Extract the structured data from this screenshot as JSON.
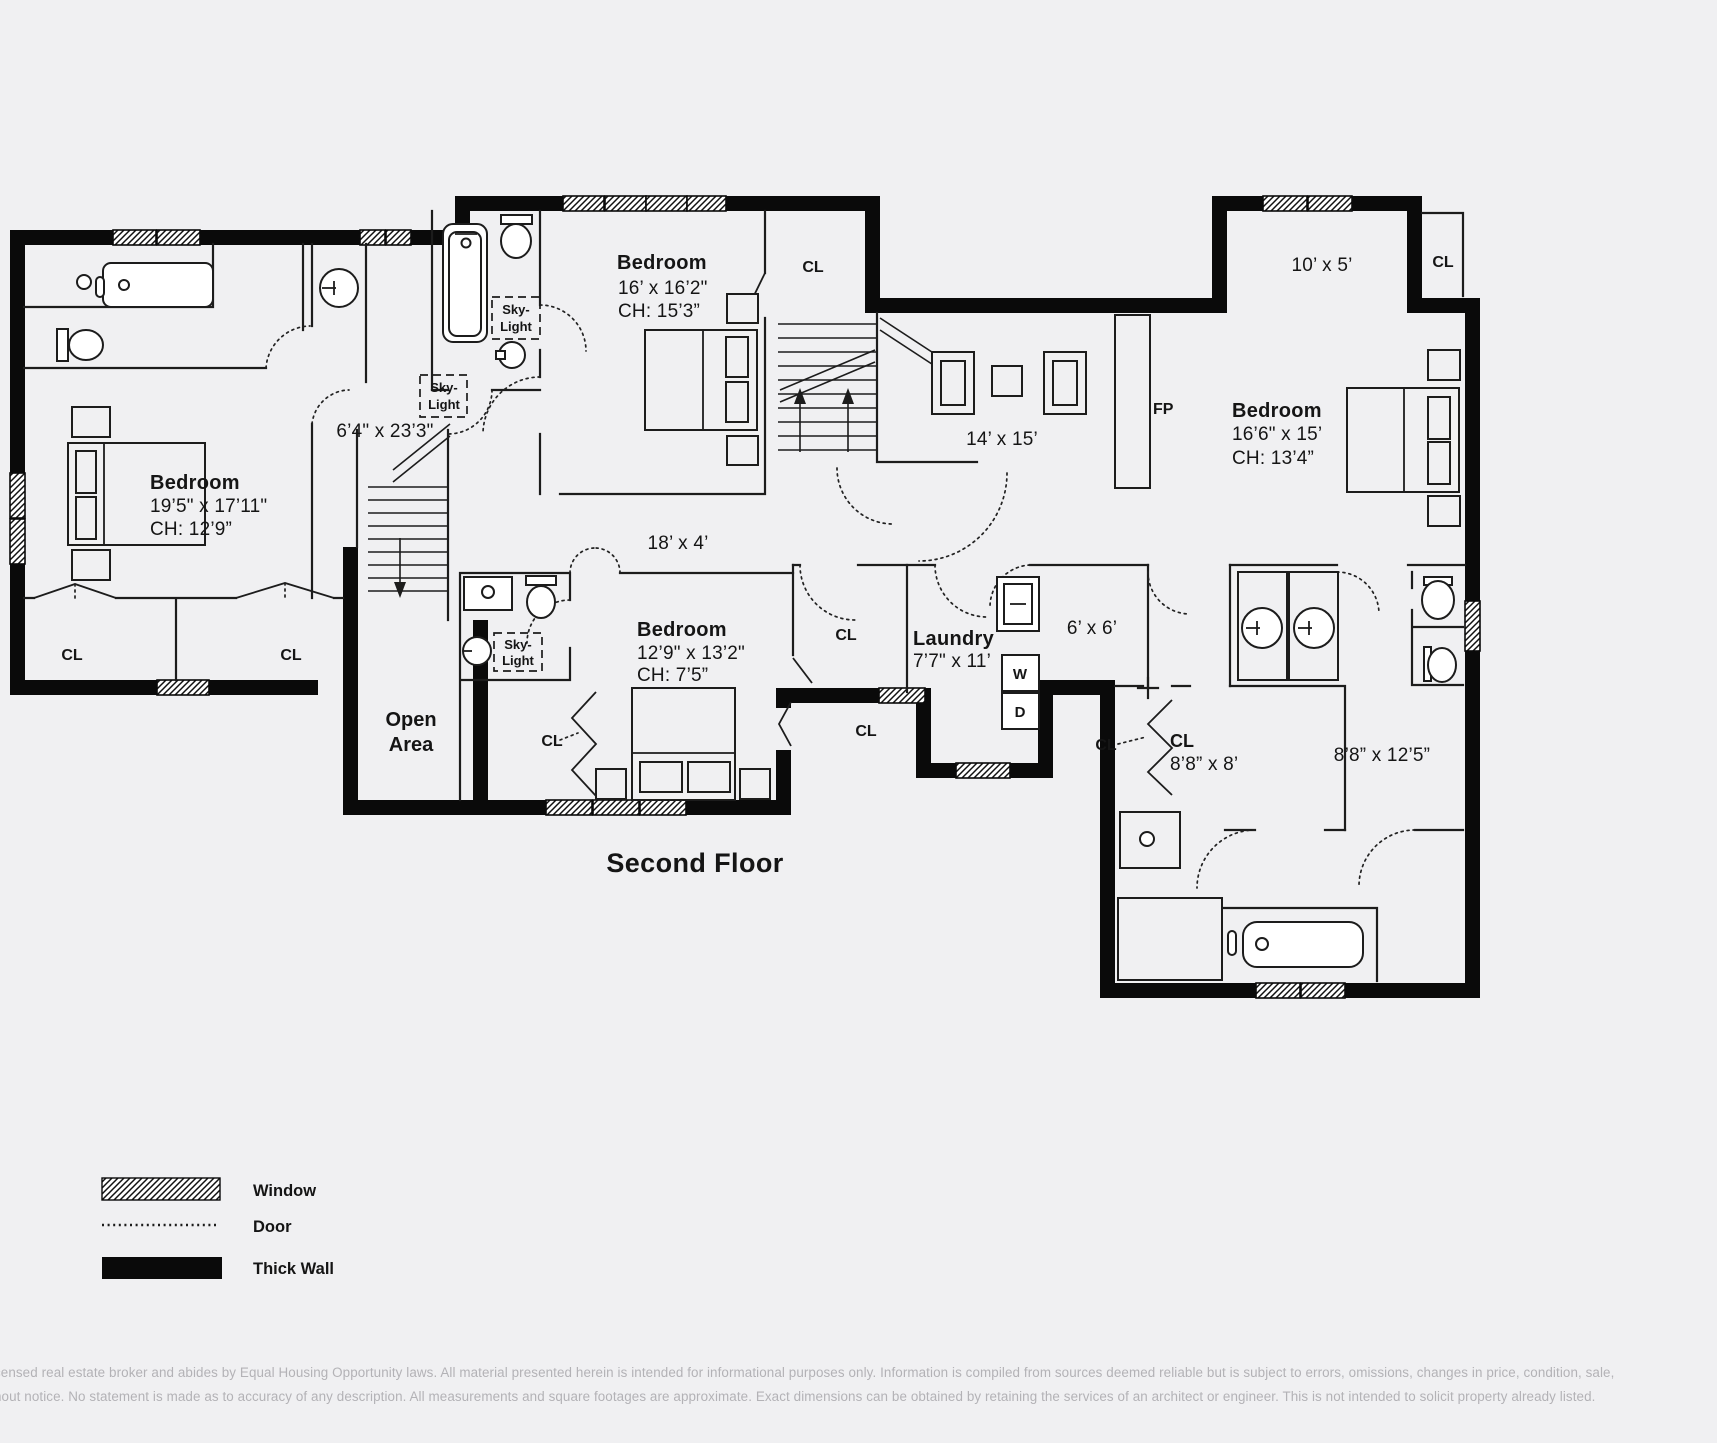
{
  "title": "Second Floor",
  "legend": {
    "window": "Window",
    "door": "Door",
    "thick_wall": "Thick Wall"
  },
  "rooms": {
    "bedroom_left": {
      "name": "Bedroom",
      "dims": "19’5\" x 17’11\"",
      "ch": "CH: 12’9”"
    },
    "bedroom_top": {
      "name": "Bedroom",
      "dims": "16’ x 16’2\"",
      "ch": "CH: 15’3”"
    },
    "bedroom_right": {
      "name": "Bedroom",
      "dims": "16’6\" x 15’",
      "ch": "CH: 13’4”"
    },
    "bedroom_middle": {
      "name": "Bedroom",
      "dims": "12’9\" x 13’2\"",
      "ch": "CH: 7’5”"
    },
    "laundry": {
      "name": "Laundry",
      "dims": "7’7\" x 11’"
    },
    "open_area": {
      "line1": "Open",
      "line2": "Area"
    },
    "sitting": {
      "dims": "14’ x 15’"
    },
    "balcony": {
      "dims": "10’ x 5’"
    },
    "hall_vertical": {
      "dims": "6’4\" x 23’3\""
    },
    "hall_horizontal": {
      "dims": "18’ x 4’"
    },
    "small_room": {
      "dims": "6’ x 6’"
    },
    "closet_big": {
      "name": "CL",
      "dims": "8’8” x 8’"
    },
    "bath_right": {
      "dims": "8’8” x 12’5”"
    }
  },
  "labels": {
    "cl": "CL",
    "fp": "FP",
    "washer": "W",
    "dryer": "D",
    "skylight_line1": "Sky-",
    "skylight_line2": "Light"
  },
  "disclaimer": {
    "line1": "censed real estate broker and abides by Equal Housing Opportunity laws. All material presented herein is intended for informational purposes only. Information is compiled from sources deemed reliable but is subject to errors, omissions, changes in price, condition, sale,",
    "line2": "hout notice. No statement is made as to accuracy of any description. All measurements and square footages are approximate. Exact dimensions can be obtained by retaining the services of an architect or engineer. This is not intended to solicit property already listed."
  },
  "colors": {
    "background": "#f0f0f2",
    "wall": "#0a0a0a",
    "line": "#1c1c1c",
    "disclaimer_text": "#b3b2b6"
  }
}
